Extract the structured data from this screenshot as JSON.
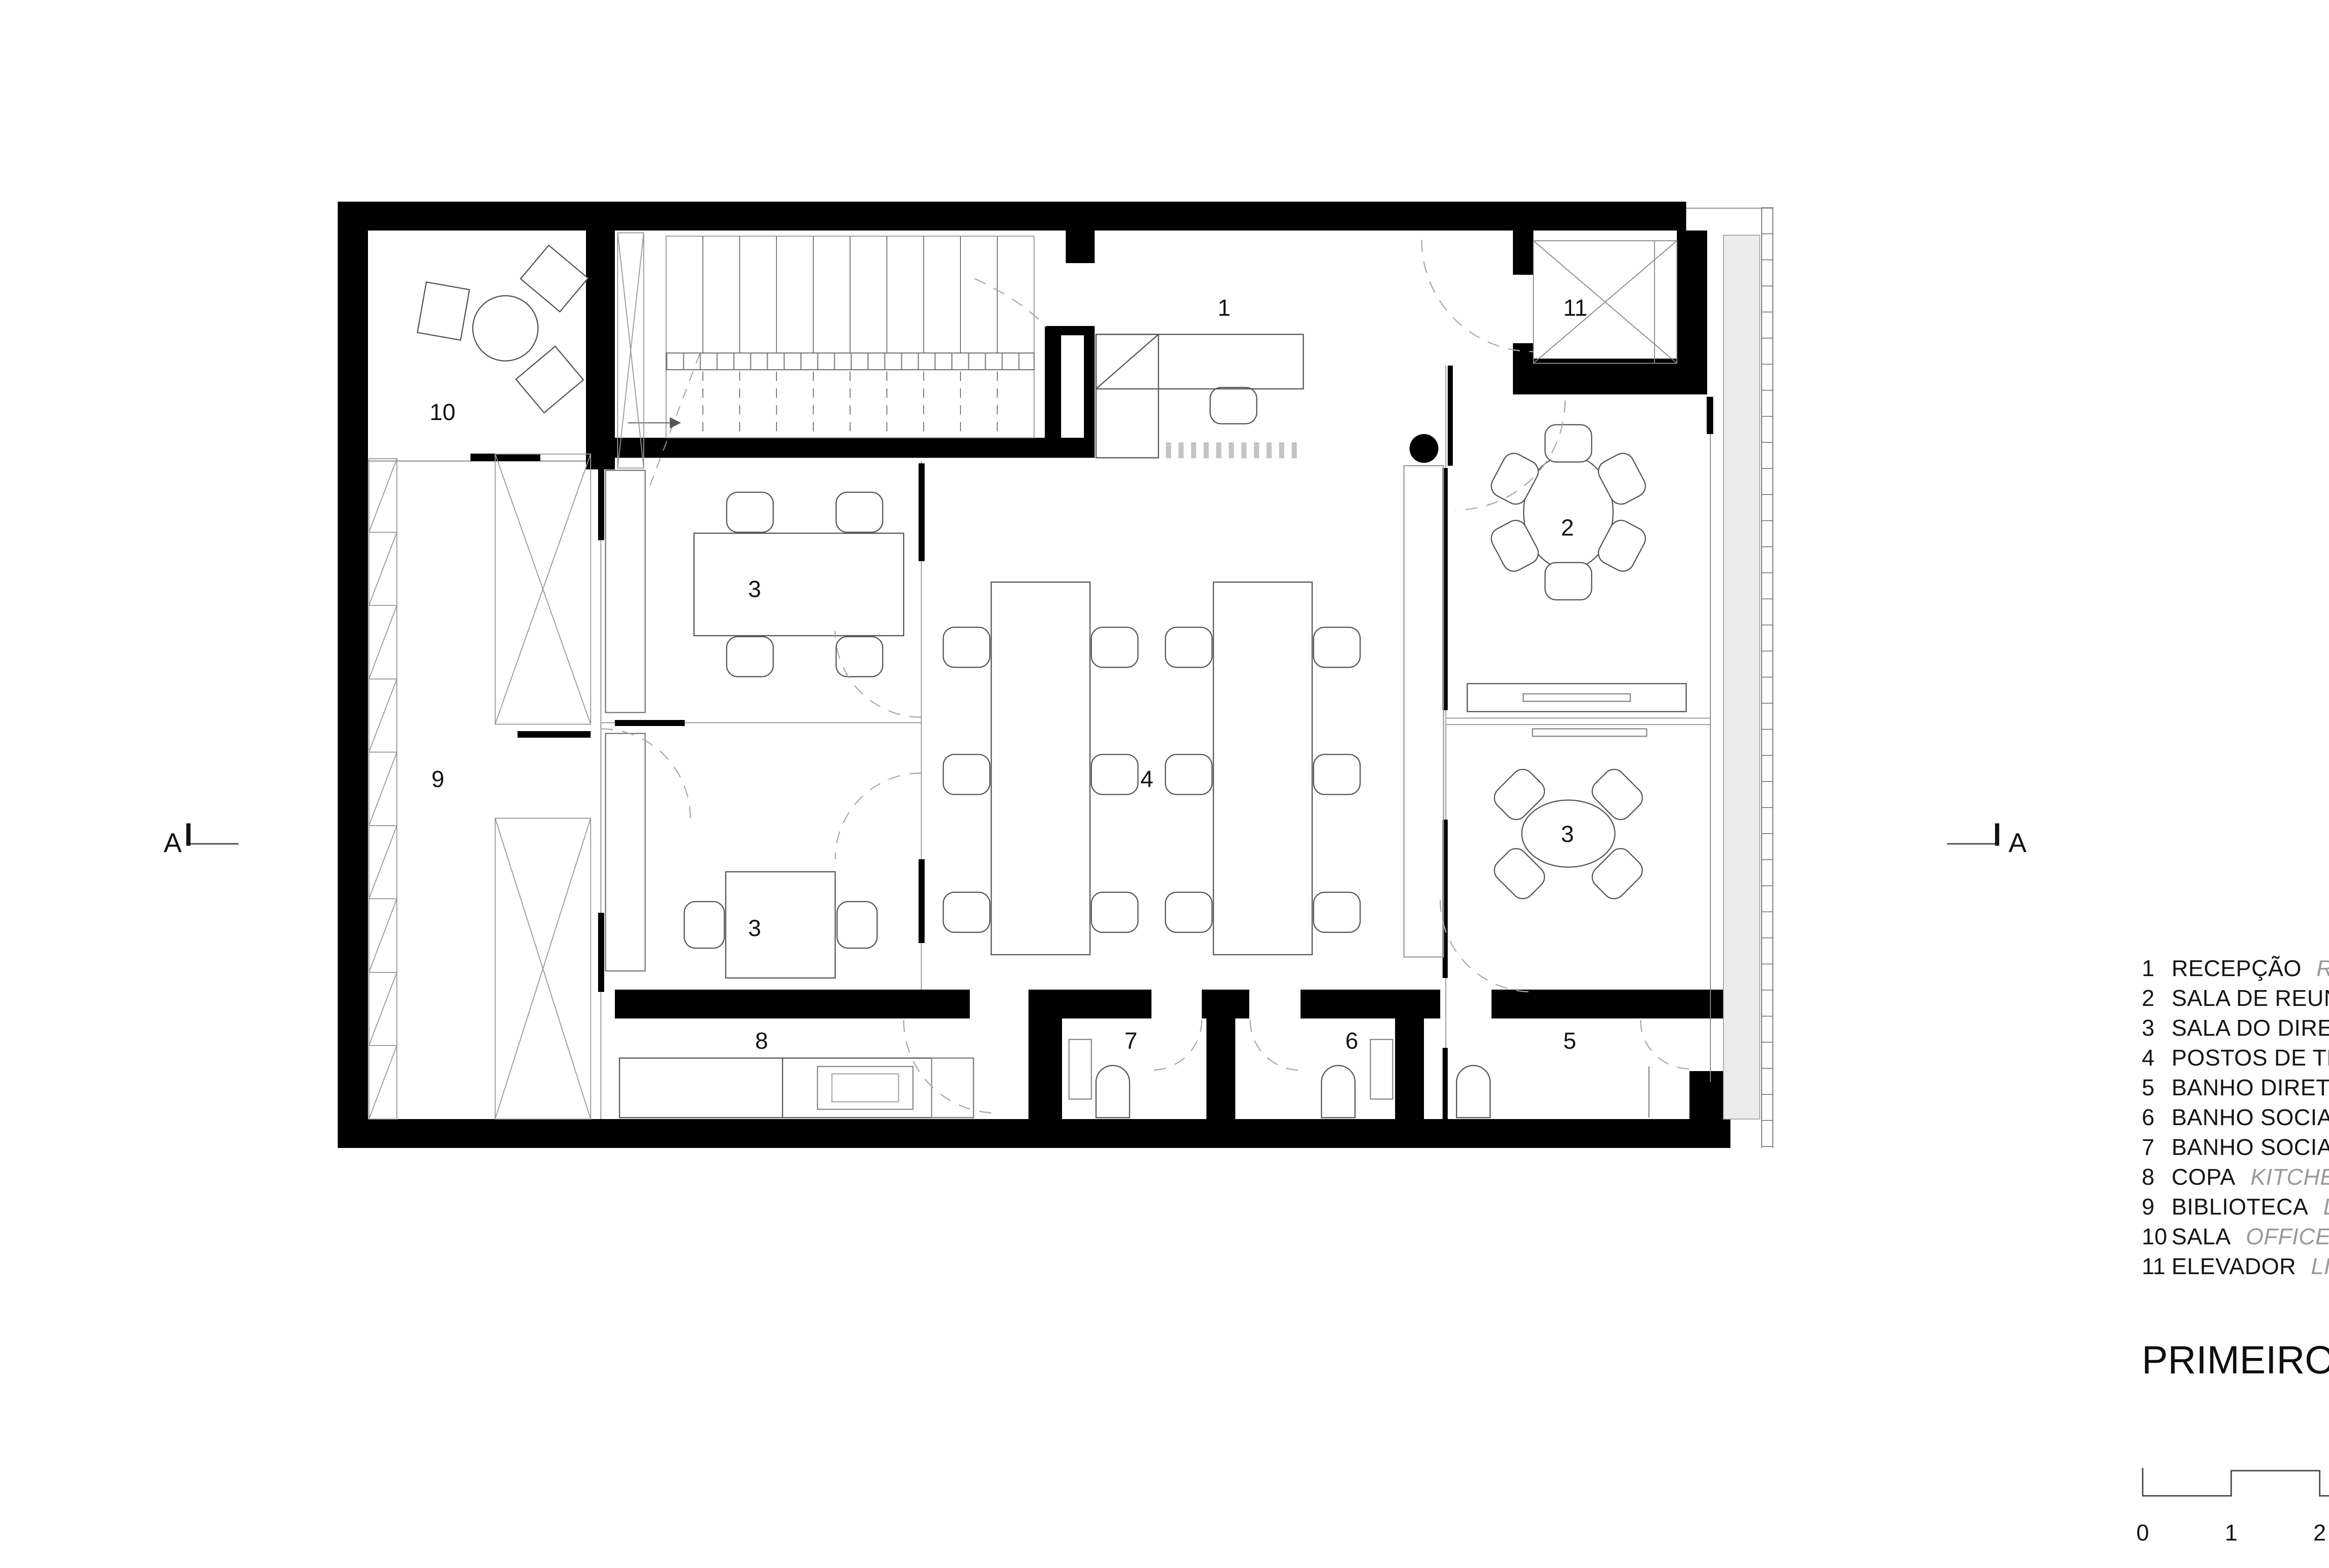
{
  "plan": {
    "room_labels": [
      {
        "text": "1"
      },
      {
        "text": "2"
      },
      {
        "text": "3"
      },
      {
        "text": "4"
      },
      {
        "text": "5"
      },
      {
        "text": "6"
      },
      {
        "text": "7"
      },
      {
        "text": "8"
      },
      {
        "text": "9"
      },
      {
        "text": "10"
      },
      {
        "text": "11"
      },
      {
        "text": "3"
      },
      {
        "text": "3"
      }
    ],
    "section_markers": [
      {
        "letter": "A"
      },
      {
        "letter": "A"
      }
    ]
  },
  "legend": {
    "items": [
      {
        "num": "1",
        "pt": "RECEPÇÃO",
        "en": "RECEPTION"
      },
      {
        "num": "2",
        "pt": "SALA DE REUNIÃO",
        "en": "MEETING ROOM"
      },
      {
        "num": "3",
        "pt": "SALA DO DIRETOR",
        "en": "DIRECTOR'S OFFICE"
      },
      {
        "num": "4",
        "pt": "POSTOS DE TRABALHO",
        "en": "WORKSPACE"
      },
      {
        "num": "5",
        "pt": "BANHO DIRETOR",
        "en": "PRIVATE BATHROOM"
      },
      {
        "num": "6",
        "pt": "BANHO SOCIAL FEMININO",
        "en": "BATHROOM"
      },
      {
        "num": "7",
        "pt": "BANHO SOCIAL MASCULINO",
        "en": "BATHROOM"
      },
      {
        "num": "8",
        "pt": "COPA",
        "en": "KITCHEN"
      },
      {
        "num": "9",
        "pt": "BIBLIOTECA",
        "en": "LIBRARY"
      },
      {
        "num": "10",
        "pt": "SALA",
        "en": "OFFICE"
      },
      {
        "num": "11",
        "pt": "ELEVADOR",
        "en": "LIFT"
      }
    ],
    "title": {
      "pt": "PRIMEIRO PAVIMENTO",
      "en": "FIRST FLOOR"
    }
  },
  "scalebar": {
    "ticks": [
      "0",
      "1",
      "2",
      "5"
    ]
  },
  "colors": {
    "wall": "#000000",
    "line": "#555555",
    "light_line": "#999999",
    "terrace": "#ececec",
    "text": "#141414",
    "muted_text": "#9a9a9a"
  }
}
